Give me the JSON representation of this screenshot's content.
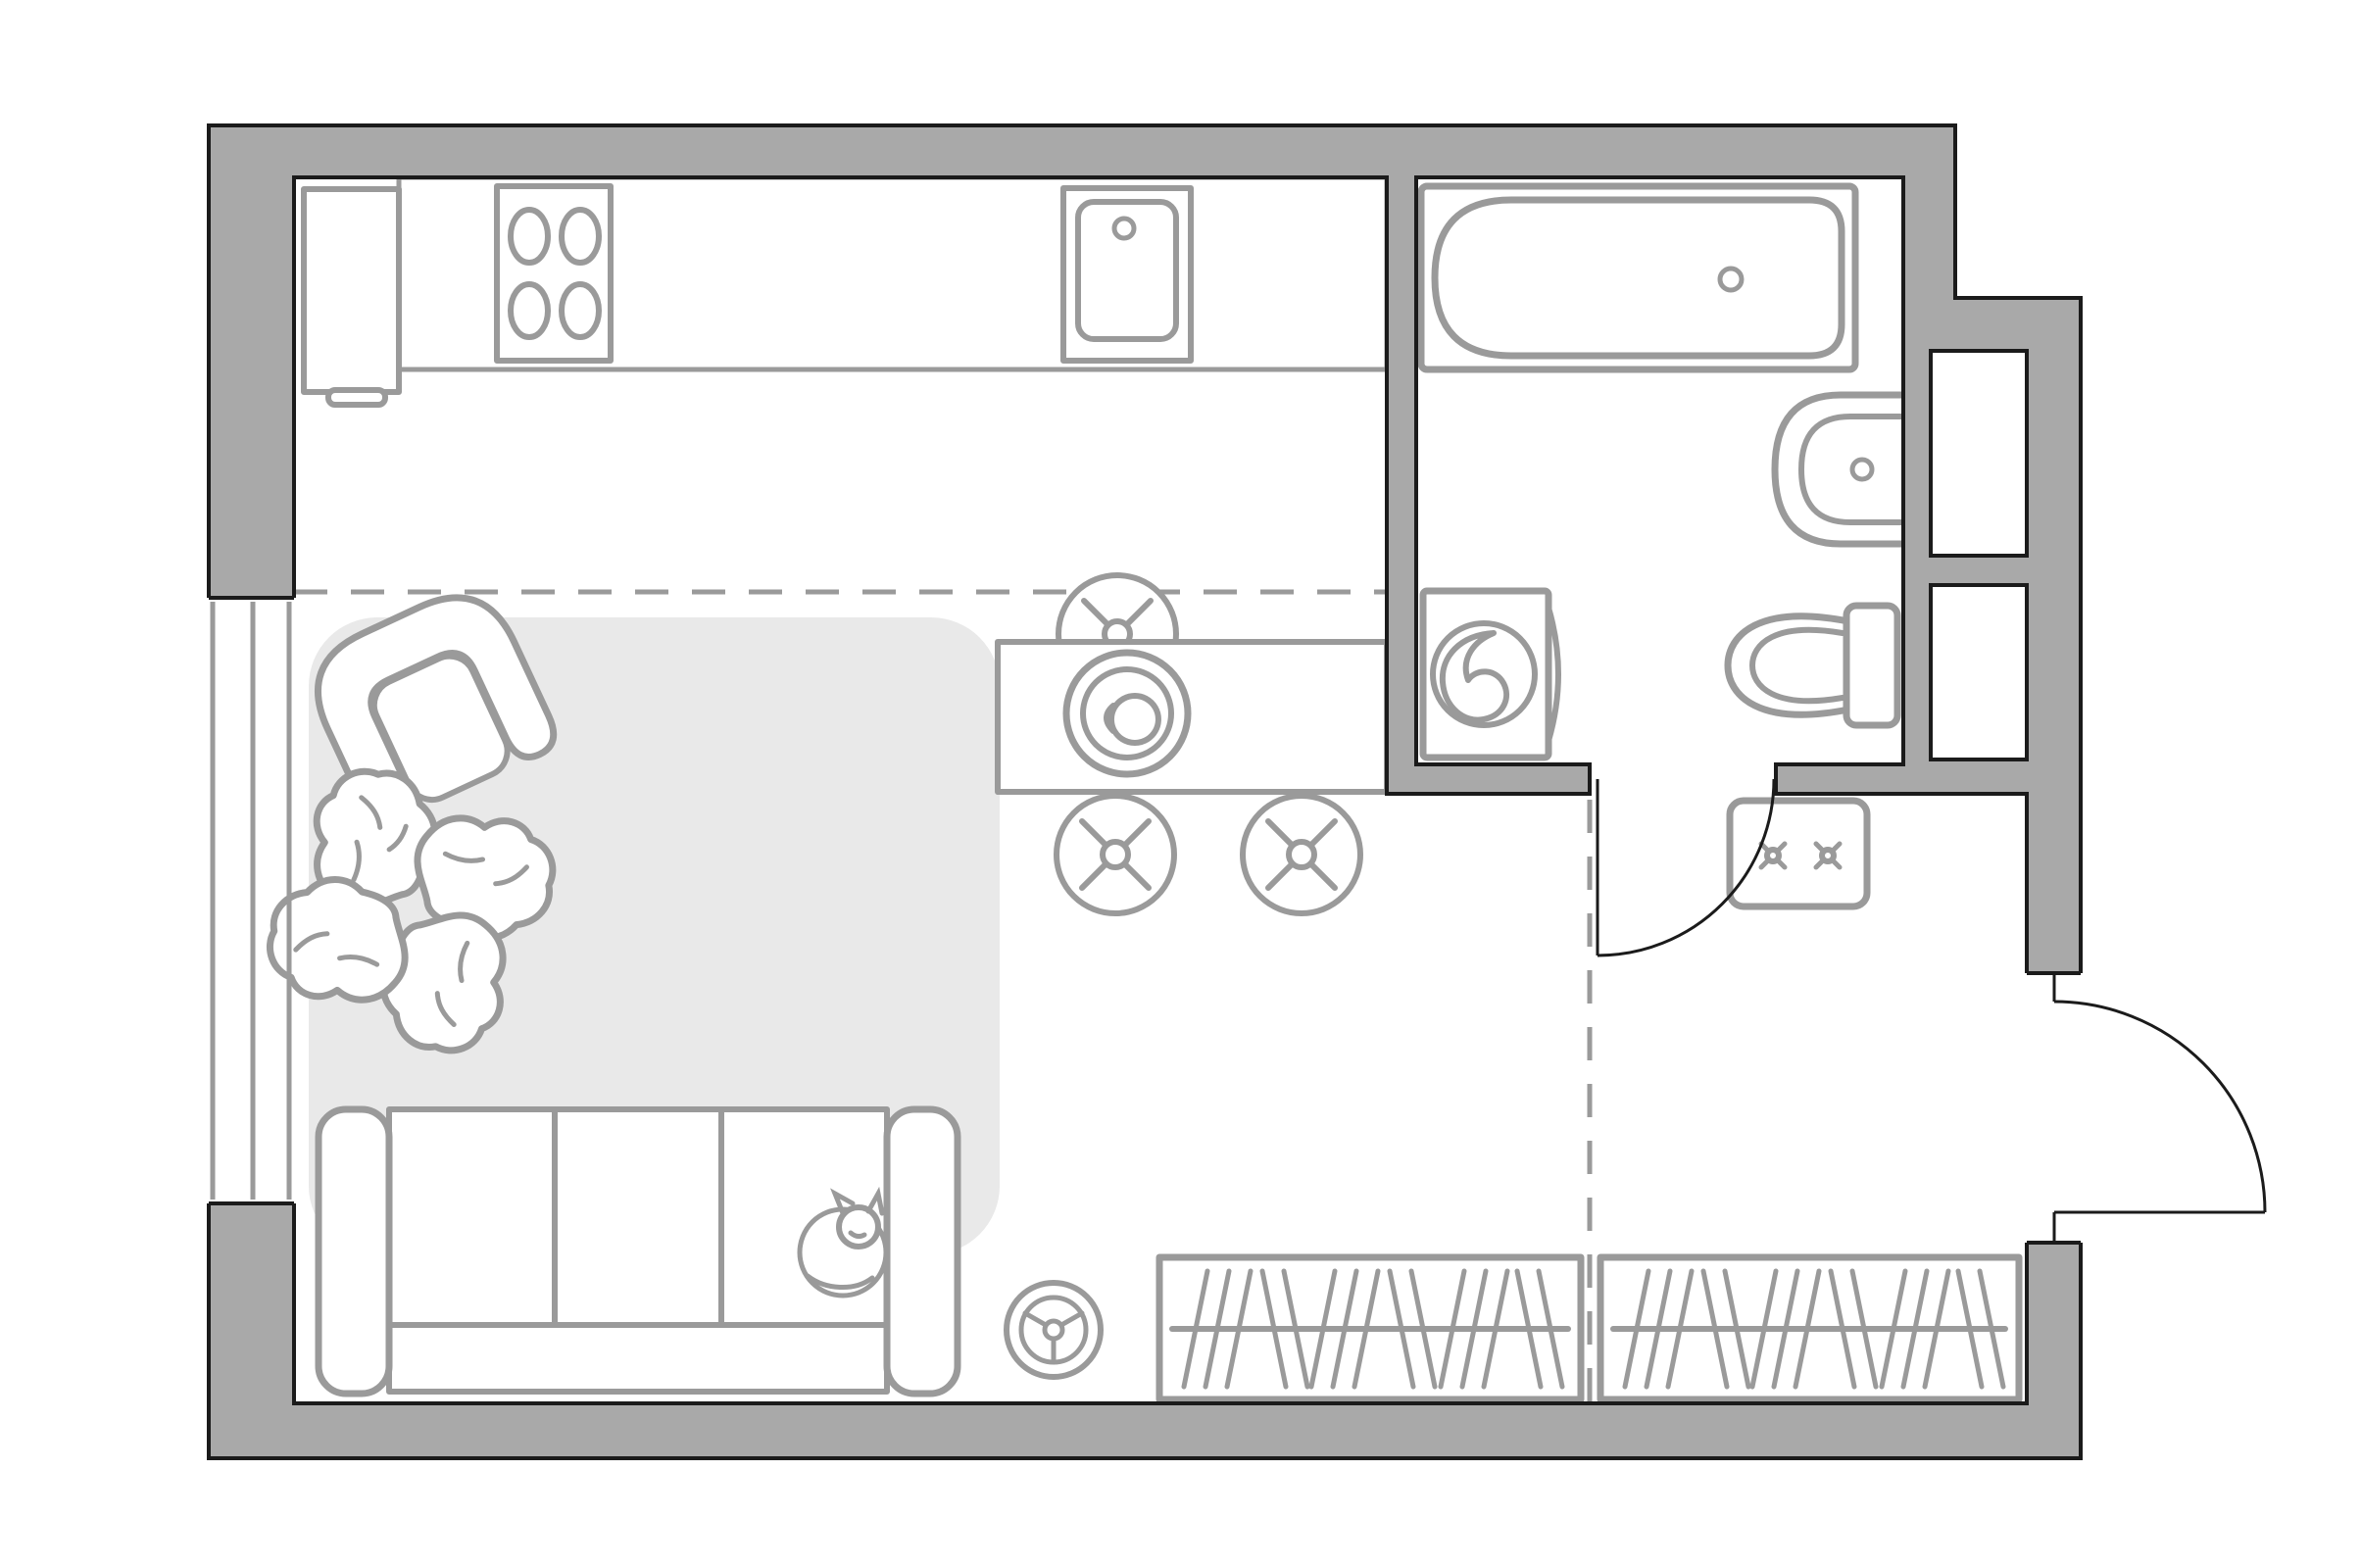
{
  "title": "Studio apartment floor plan (top view)",
  "colors": {
    "background": "#ffffff",
    "wall_fill": "#a9a9a9",
    "outline": "#1b1b1b",
    "furniture_stroke": "#9a9a9a",
    "rug_fill": "#e9e9e9",
    "floor": "#ffffff"
  },
  "rooms": [
    {
      "id": "kitchen-living",
      "label": "combined kitchen and living area"
    },
    {
      "id": "bathroom",
      "label": "bathroom"
    },
    {
      "id": "hallway",
      "label": "entry hallway"
    }
  ],
  "elements": [
    {
      "id": "exterior-walls",
      "label": "thick gray exterior walls with black outline"
    },
    {
      "id": "window",
      "label": "window in left wall (triple line symbol)"
    },
    {
      "id": "fridge",
      "label": "refrigerator with door handle"
    },
    {
      "id": "kitchen-counter",
      "label": "kitchen countertop along top wall"
    },
    {
      "id": "stove",
      "label": "cooktop with 4 burners"
    },
    {
      "id": "kitchen-sink",
      "label": "kitchen sink with faucet"
    },
    {
      "id": "dining-table",
      "label": "dining table with plate and cup"
    },
    {
      "id": "dining-chair",
      "label": "three stools with cross marks"
    },
    {
      "id": "bathtub",
      "label": "bathtub with drain"
    },
    {
      "id": "washing-machine",
      "label": "washing machine with drum"
    },
    {
      "id": "bathroom-sink",
      "label": "wall-mounted half-round basin"
    },
    {
      "id": "toilet",
      "label": "toilet with tank"
    },
    {
      "id": "utility-shafts",
      "label": "two shafts in right wall"
    },
    {
      "id": "bathroom-door",
      "label": "bathroom swing door"
    },
    {
      "id": "entry-door",
      "label": "entry swing door opening outward"
    },
    {
      "id": "shoe-cabinet",
      "label": "hallway cabinet with two cross marks"
    },
    {
      "id": "zone-dashes",
      "label": "dashed zone-divider lines"
    },
    {
      "id": "rug",
      "label": "light gray area rug"
    },
    {
      "id": "armchair",
      "label": "rotated armchair"
    },
    {
      "id": "monstera-plant",
      "label": "monstera plant"
    },
    {
      "id": "sofa",
      "label": "three-seat sofa"
    },
    {
      "id": "cat",
      "label": "cat curled on sofa"
    },
    {
      "id": "fan",
      "label": "small three-spoke fan wheel"
    },
    {
      "id": "wardrobe-left",
      "label": "wardrobe with hangers (left)"
    },
    {
      "id": "wardrobe-right",
      "label": "wardrobe with hangers (right)"
    }
  ]
}
